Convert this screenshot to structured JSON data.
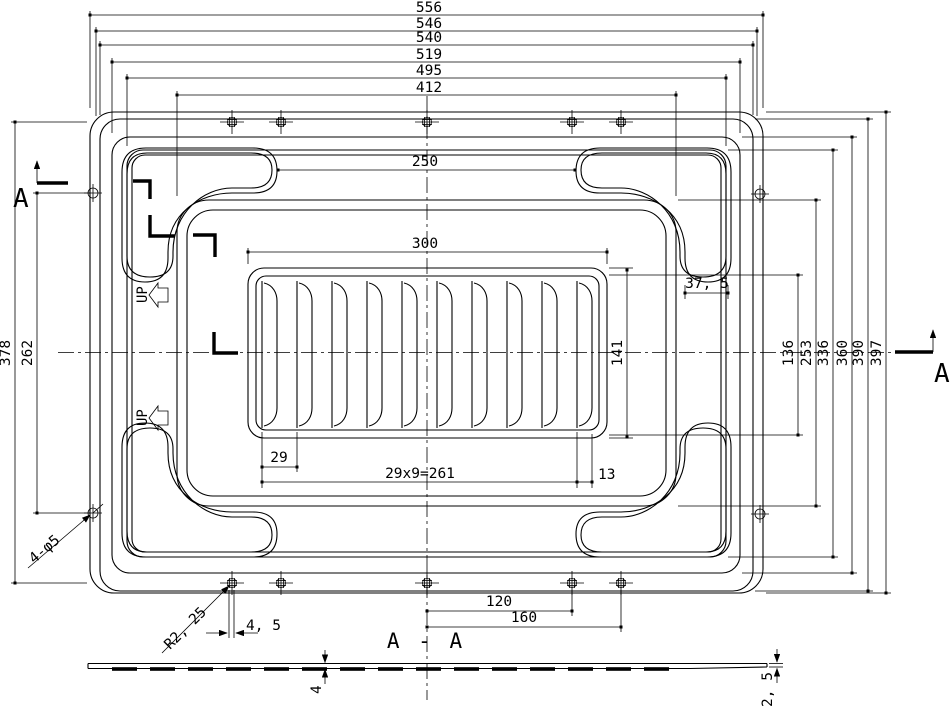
{
  "drawing": {
    "type": "engineering-drawing",
    "colors": {
      "line": "#000000",
      "background": "#ffffff"
    },
    "plan": {
      "dims_top": {
        "d556": "556",
        "d546": "546",
        "d540": "540",
        "d519": "519",
        "d495": "495",
        "d412": "412",
        "d250": "250",
        "d300": "300"
      },
      "dims_right": {
        "d141": "141",
        "d136": "136",
        "d253": "253",
        "d336": "336",
        "d360": "360",
        "d390": "390",
        "d397": "397",
        "d37_5": "37, 5"
      },
      "dims_left": {
        "d378": "378",
        "d262": "262"
      },
      "dims_bottom": {
        "d29": "29",
        "d261": "29x9=261",
        "d13": "13",
        "d120": "120",
        "d160": "160",
        "d4_5": "4, 5"
      },
      "notes": {
        "holes": "4-φ5",
        "radius": "R2, 25"
      },
      "up_label": "UP",
      "section_marker": "A"
    },
    "section": {
      "title": "A - A",
      "thickness_center": "4",
      "thickness_edge": "2, 5"
    }
  }
}
